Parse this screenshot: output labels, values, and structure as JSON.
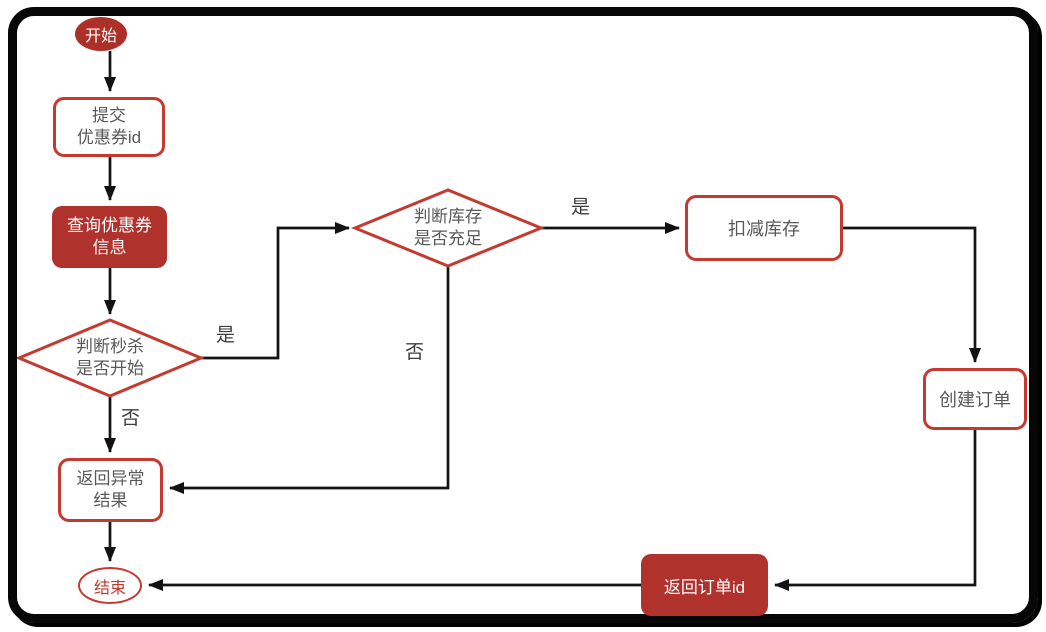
{
  "diagram": {
    "type": "flowchart",
    "background": "#ffffff",
    "frame_color": "#070707",
    "colors": {
      "filled_node_red": "#AF322C",
      "outline_stroke_red": "#C43A31",
      "node_text_gray": "#595959",
      "node_text_white": "#ffffff",
      "end_text_red": "#C0392B",
      "edge_line": "#141414",
      "edge_label_text": "#3d3d3d"
    },
    "nodes": {
      "start": {
        "label": "开始"
      },
      "submit_coupon": {
        "lines": [
          "提交",
          "优惠券id"
        ]
      },
      "query_coupon": {
        "lines": [
          "查询优惠券",
          "信息"
        ]
      },
      "check_seckill": {
        "lines": [
          "判断秒杀",
          "是否开始"
        ]
      },
      "return_error": {
        "lines": [
          "返回异常",
          "结果"
        ]
      },
      "end": {
        "label": "结束"
      },
      "check_stock": {
        "lines": [
          "判断库存",
          "是否充足"
        ]
      },
      "deduct_stock": {
        "label": "扣减库存"
      },
      "create_order": {
        "label": "创建订单"
      },
      "return_order_id": {
        "label": "返回订单id"
      }
    },
    "edge_labels": {
      "seckill_yes": "是",
      "seckill_no": "否",
      "stock_yes": "是",
      "stock_no": "否"
    }
  }
}
